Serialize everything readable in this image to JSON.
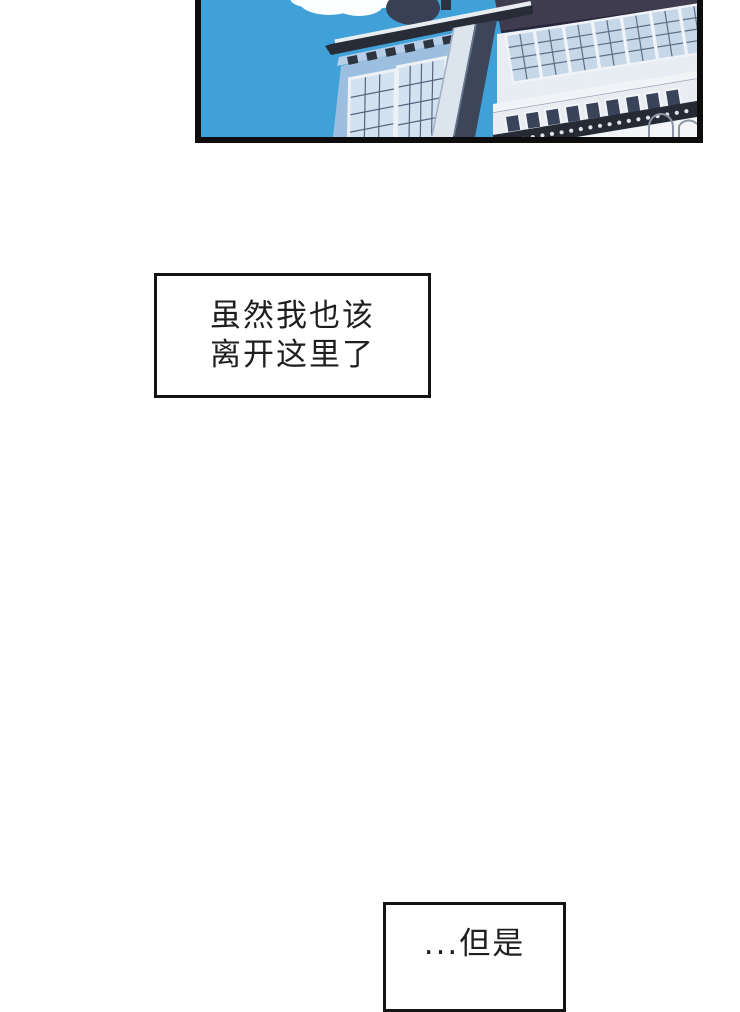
{
  "page": {
    "background": "#ffffff"
  },
  "panel": {
    "description": "partial comic panel: building facades against blue sky with clouds",
    "colors": {
      "border": "#0d0d0d",
      "sky": "#3fa1d8",
      "cloud": "#fdfeff",
      "dome": "#394053",
      "cornice": "#272c37",
      "cornice_edge": "#e9edf2",
      "eave": "#b6cee7",
      "vent": "#2e3440",
      "facade": "#9cbedf",
      "window_frame": "#edf1f6",
      "window_pane": "#d3e2f1",
      "mullion": "#53637d",
      "pilaster": "#dce4ee",
      "corner_strip": "#3d4659",
      "upper_wall": "#403c50",
      "upper_wall_edge": "#29263a",
      "band_bg": "#e8edf3",
      "window2_pane": "#c6d7e8",
      "window2_frame": "#f0f3f7",
      "mullion2": "#5d6d87",
      "ledge": "#f1f4f7",
      "ledge_shadow": "#9aa5b5",
      "balustrade": "#e9edf2",
      "opening": "#39445a",
      "trim_band": "#252a35",
      "bead": "#dde4ec",
      "lower_wall": "#f3f5f7",
      "arch_line": "#8c95a5"
    }
  },
  "speech": {
    "box_top": {
      "line1": "虽然我也该",
      "line2": "离开这里了",
      "border_color": "#141414"
    },
    "box_bottom": {
      "line1": "...但是",
      "border_color": "#141414"
    }
  }
}
